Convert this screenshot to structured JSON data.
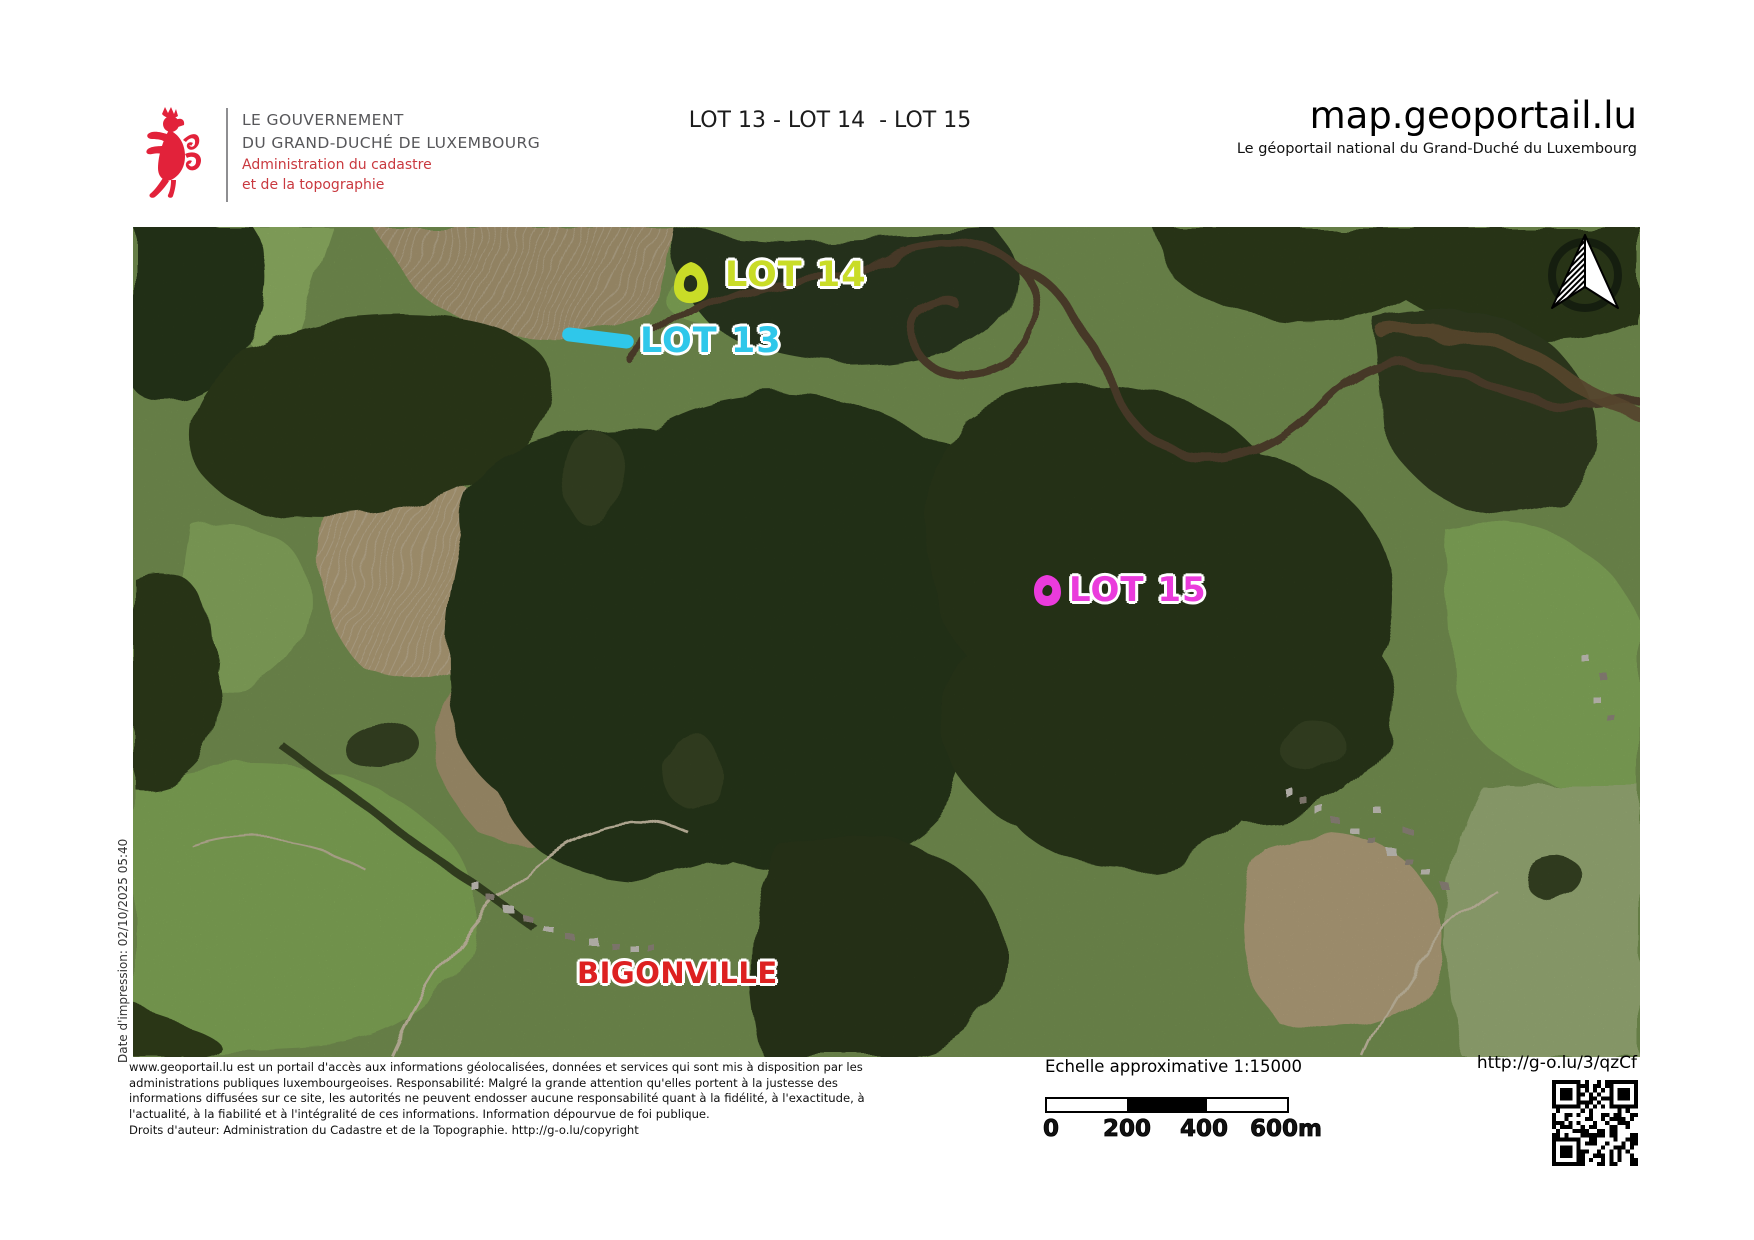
{
  "header": {
    "government_line1": "LE GOUVERNEMENT",
    "government_line2": "DU GRAND-DUCHÉ DE LUXEMBOURG",
    "administration_line1": "Administration du cadastre",
    "administration_line2": "et de la topographie",
    "title": "LOT 13 - LOT 14  - LOT 15",
    "brand": "map.geoportail.lu",
    "subtitle": "Le géoportail national du Grand-Duché du Luxembourg"
  },
  "map": {
    "labels": [
      {
        "text": "LOT 14",
        "color": "#c9dc27"
      },
      {
        "text": "LOT 13",
        "color": "#2fc7ea"
      },
      {
        "text": "LOT 15",
        "color": "#ea3bdc"
      },
      {
        "text": "BIGONVILLE",
        "color": "#dd2121"
      }
    ],
    "print_date": "Date d'impression: 02/10/2025 05:40"
  },
  "footer": {
    "disclaimer": [
      "www.geoportail.lu est un portail d'accès aux informations géolocalisées, données et services qui sont mis à disposition par les",
      "administrations publiques luxembourgeoises. Responsabilité: Malgré la grande attention qu'elles portent à la justesse des",
      "informations diffusées sur ce site, les autorités ne peuvent endosser aucune responsabilité quant à la fidélité, à l'exactitude, à",
      "l'actualité, à la fiabilité et à l'intégralité de ces informations. Information dépourvue de foi publique.",
      "Droits d'auteur: Administration du Cadastre et de la Topographie. http://g-o.lu/copyright"
    ],
    "scale_label": "Echelle approximative 1:15000",
    "scale_ticks": [
      "0",
      "200",
      "400",
      "600m"
    ],
    "short_url": "http://g-o.lu/3/qzCf"
  }
}
